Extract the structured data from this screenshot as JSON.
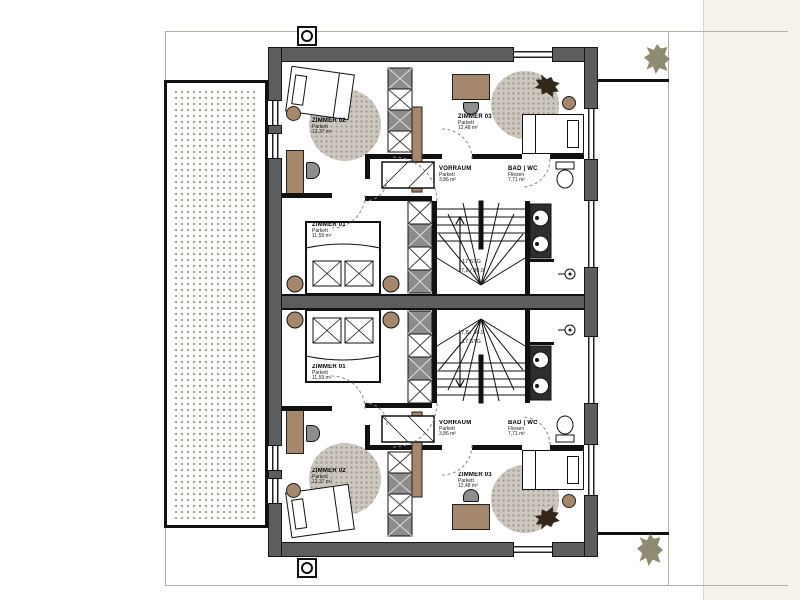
{
  "plan": {
    "rooms": {
      "zimmer01": {
        "name": "ZIMMER 01",
        "floor": "Parkett",
        "area": "11,59 m²"
      },
      "zimmer02": {
        "name": "ZIMMER 02",
        "floor": "Parkett",
        "area": "12,37 m²"
      },
      "zimmer03": {
        "name": "ZIMMER 03",
        "floor": "Parkett",
        "area": "12,48 m²"
      },
      "vorraum": {
        "name": "VORRAUM",
        "floor": "Parkett",
        "area": "3,86 m²"
      },
      "bad": {
        "name": "BAD | WC",
        "floor": "Fliesen",
        "area": "7,71 m²"
      }
    },
    "stairs": {
      "count": "17 STG",
      "step": "17,8 / 30,0"
    },
    "colors": {
      "wall": "#5d5d5d",
      "furniture": "#a5876c",
      "rug": "#ccc8bf",
      "line_black": "#111111",
      "paper_margin": "#f5f2e9",
      "tree": "#8f8b72"
    }
  }
}
